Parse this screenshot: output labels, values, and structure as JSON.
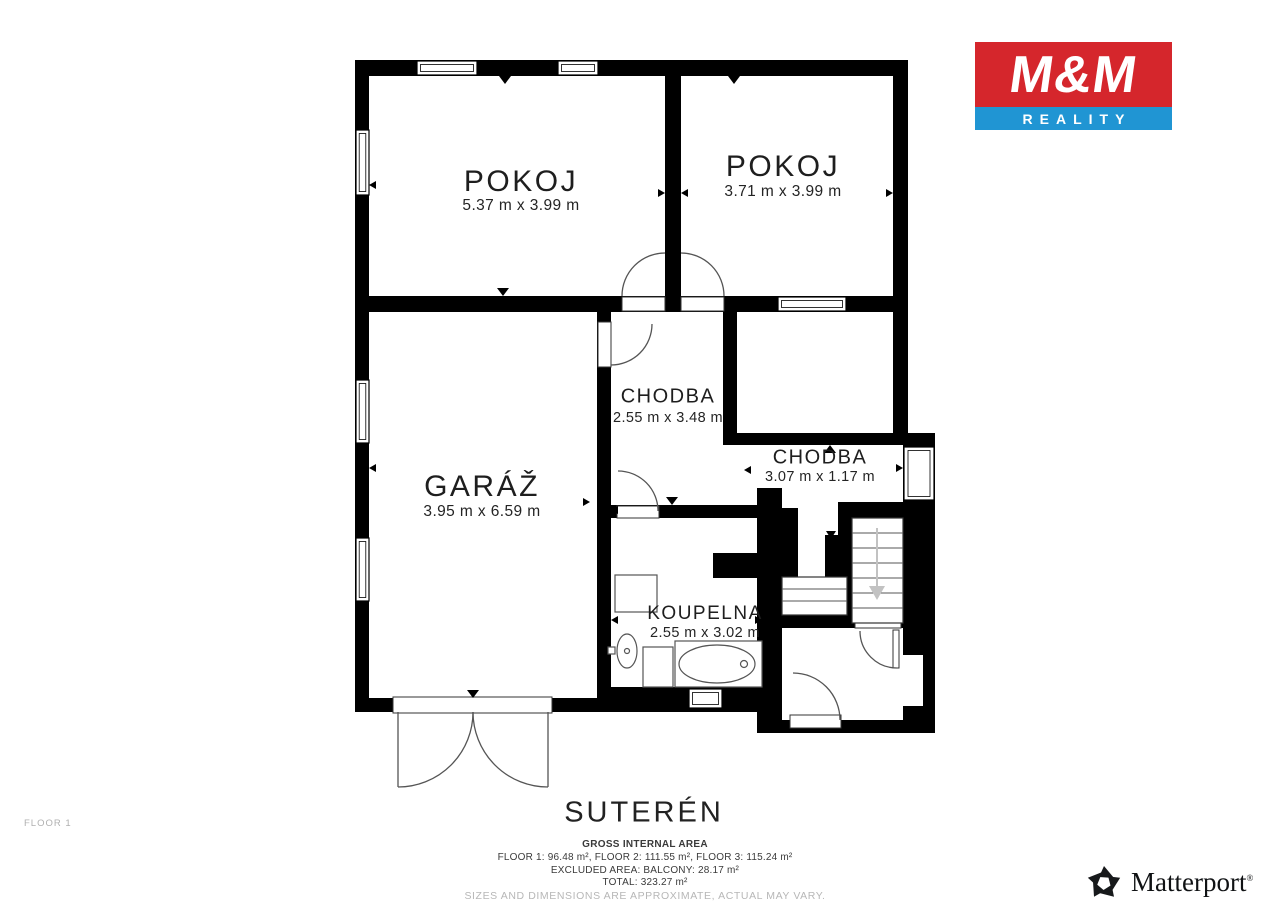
{
  "branding": {
    "mm_logo": {
      "title": "M&M",
      "subtitle": "REALITY",
      "red": "#d5262c",
      "blue": "#2095d3"
    },
    "matterport": {
      "name": "Matterport",
      "registered_mark": "®"
    }
  },
  "plan": {
    "floor_tag": "FLOOR 1",
    "title": "SUTERÉN",
    "rooms": [
      {
        "id": "pokoj-left",
        "name": "POKOJ",
        "dims": "5.37 m x 3.99 m"
      },
      {
        "id": "pokoj-right",
        "name": "POKOJ",
        "dims": "3.71 m x 3.99 m"
      },
      {
        "id": "chodba-1",
        "name": "CHODBA",
        "dims": "2.55 m x 3.48 m"
      },
      {
        "id": "chodba-2",
        "name": "CHODBA",
        "dims": "3.07 m x 1.17 m"
      },
      {
        "id": "garaz",
        "name": "GARÁŽ",
        "dims": "3.95 m x 6.59 m"
      },
      {
        "id": "koupelna",
        "name": "KOUPELNA",
        "dims": "2.55 m x 3.02 m"
      }
    ],
    "footer": {
      "heading": "GROSS INTERNAL AREA",
      "line1": "FLOOR 1: 96.48 m², FLOOR 2: 111.55 m², FLOOR 3: 115.24 m²",
      "line2": "EXCLUDED AREA: BALCONY: 28.17 m²",
      "line3": "TOTAL: 323.27 m²",
      "disclaimer": "SIZES AND DIMENSIONS ARE APPROXIMATE, ACTUAL MAY VARY."
    }
  }
}
